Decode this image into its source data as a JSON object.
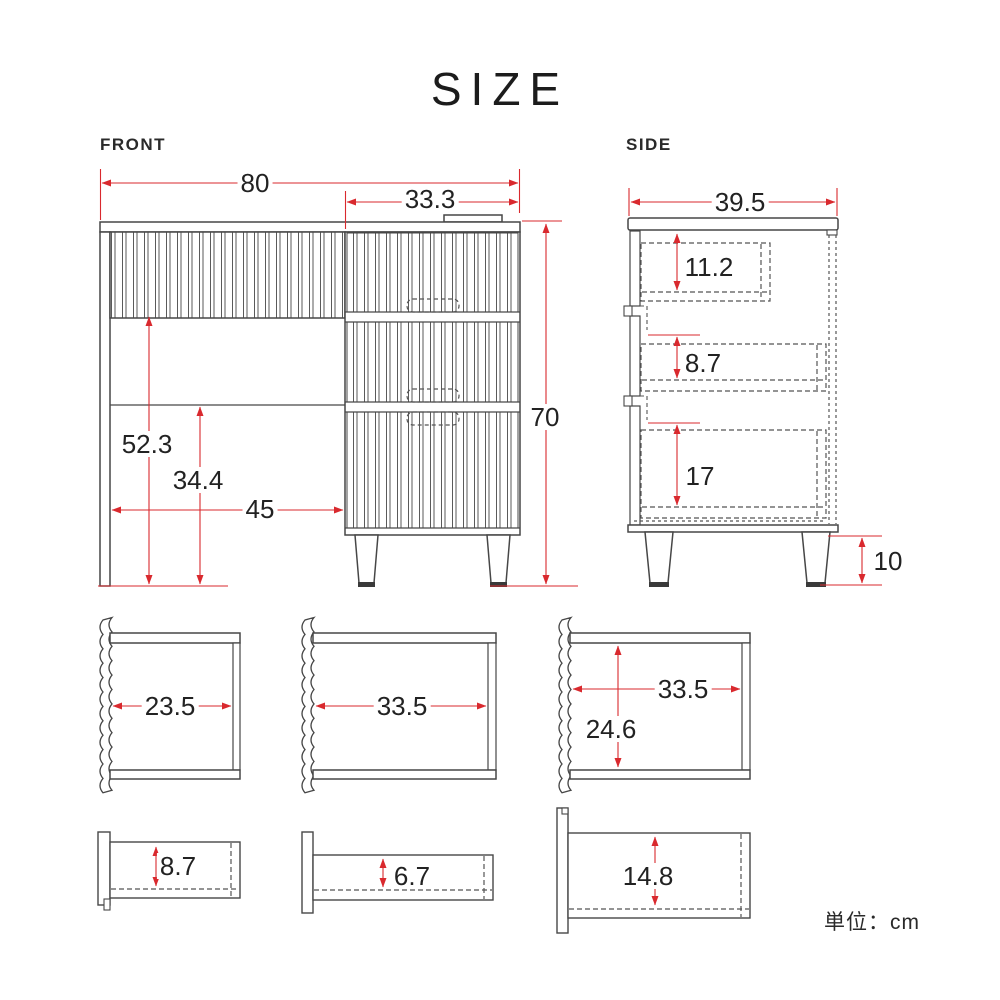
{
  "title": "SIZE",
  "unit_note": "単位：cm",
  "colors": {
    "dimension_red": "#d9292e",
    "line_gray": "#474747"
  },
  "front": {
    "label": "FRONT",
    "dimensions": {
      "total_width": "80",
      "chest_width": "33.3",
      "total_height": "70",
      "desk_clearance_height": "52.3",
      "crossbar_height": "34.4",
      "knee_space_width": "45"
    }
  },
  "side": {
    "label": "SIDE",
    "dimensions": {
      "depth": "39.5",
      "top_drawer_inner_depth": "11.2",
      "middle_drawer_inner_depth": "8.7",
      "bottom_drawer_inner_depth": "17",
      "leg_height": "10"
    }
  },
  "detail_views": {
    "left_compartment_width": "23.5",
    "center_compartment_width": "33.5",
    "right_compartment_width": "33.5",
    "right_compartment_height": "24.6",
    "top_drawer_inner_depth": "8.7",
    "middle_drawer_inner_depth": "6.7",
    "bottom_drawer_inner_depth": "14.8"
  }
}
